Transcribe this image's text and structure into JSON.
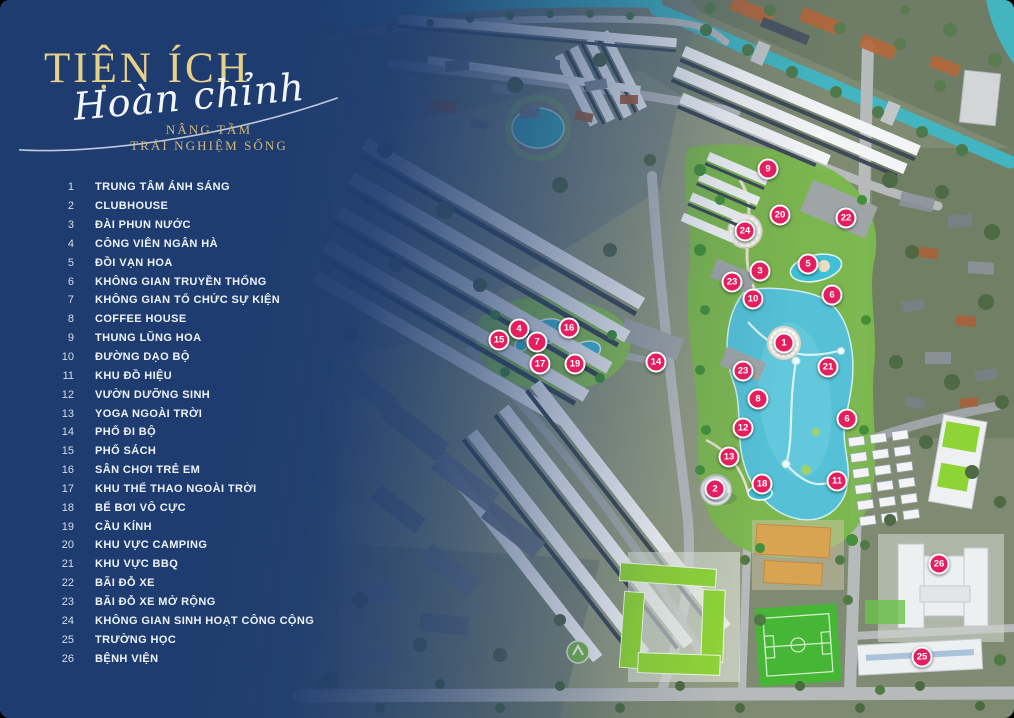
{
  "colors": {
    "navy": "#1e3c6f",
    "gold-title": "#e7d088",
    "gold-tagline": "#d2b878",
    "panel-text": "#edf3fb",
    "marker-bg": "#e51e5f",
    "marker-border": "#ffffff"
  },
  "panel": {
    "title": "TIỆN ÍCH",
    "subtitle_script": "Hoàn chỉnh",
    "tagline_line1": "NÂNG TẦM",
    "tagline_line2": "TRẢI NGHIỆM SỐNG",
    "items": [
      {
        "num": "1",
        "label": "TRUNG TÂM ÁNH SÁNG"
      },
      {
        "num": "2",
        "label": "CLUBHOUSE"
      },
      {
        "num": "3",
        "label": "ĐÀI PHUN NƯỚC"
      },
      {
        "num": "4",
        "label": "CÔNG VIÊN NGÂN HÀ"
      },
      {
        "num": "5",
        "label": "ĐỒI VẠN HOA"
      },
      {
        "num": "6",
        "label": "KHÔNG GIAN TRUYỀN THỐNG"
      },
      {
        "num": "7",
        "label": "KHÔNG GIAN TỔ CHỨC SỰ KIỆN"
      },
      {
        "num": "8",
        "label": "COFFEE HOUSE"
      },
      {
        "num": "9",
        "label": "THUNG LŨNG HOA"
      },
      {
        "num": "10",
        "label": "ĐƯỜNG DẠO BỘ"
      },
      {
        "num": "11",
        "label": "KHU ĐỒ HIỆU"
      },
      {
        "num": "12",
        "label": "VƯỜN DƯỠNG SINH"
      },
      {
        "num": "13",
        "label": "YOGA NGOÀI TRỜI"
      },
      {
        "num": "14",
        "label": "PHỐ ĐI BỘ"
      },
      {
        "num": "15",
        "label": "PHỐ SÁCH"
      },
      {
        "num": "16",
        "label": "SÂN CHƠI TRẺ EM"
      },
      {
        "num": "17",
        "label": "KHU THỂ THAO NGOÀI TRỜI"
      },
      {
        "num": "18",
        "label": "BỂ BƠI VÔ CỰC"
      },
      {
        "num": "19",
        "label": "CẦU KÍNH"
      },
      {
        "num": "20",
        "label": "KHU VỰC CAMPING"
      },
      {
        "num": "21",
        "label": "KHU VỰC BBQ"
      },
      {
        "num": "22",
        "label": "BÃI ĐỖ XE"
      },
      {
        "num": "23",
        "label": "BÃI ĐỖ XE MỞ RỘNG"
      },
      {
        "num": "24",
        "label": "KHÔNG GIAN SINH HOẠT CÔNG CỘNG"
      },
      {
        "num": "25",
        "label": "TRƯỜNG HỌC"
      },
      {
        "num": "26",
        "label": "BỆNH VIỆN"
      }
    ]
  },
  "map": {
    "markers": [
      {
        "n": "1",
        "x": 784,
        "y": 343
      },
      {
        "n": "2",
        "x": 715,
        "y": 489
      },
      {
        "n": "3",
        "x": 760,
        "y": 271
      },
      {
        "n": "4",
        "x": 519,
        "y": 329
      },
      {
        "n": "5",
        "x": 808,
        "y": 264
      },
      {
        "n": "6",
        "x": 832,
        "y": 295
      },
      {
        "n": "6",
        "x": 847,
        "y": 419
      },
      {
        "n": "7",
        "x": 537,
        "y": 342
      },
      {
        "n": "8",
        "x": 758,
        "y": 399
      },
      {
        "n": "9",
        "x": 768,
        "y": 169
      },
      {
        "n": "10",
        "x": 753,
        "y": 299
      },
      {
        "n": "11",
        "x": 837,
        "y": 481
      },
      {
        "n": "12",
        "x": 743,
        "y": 428
      },
      {
        "n": "13",
        "x": 729,
        "y": 457
      },
      {
        "n": "14",
        "x": 656,
        "y": 362
      },
      {
        "n": "15",
        "x": 499,
        "y": 340
      },
      {
        "n": "16",
        "x": 569,
        "y": 328
      },
      {
        "n": "17",
        "x": 540,
        "y": 364
      },
      {
        "n": "18",
        "x": 762,
        "y": 484
      },
      {
        "n": "19",
        "x": 575,
        "y": 364
      },
      {
        "n": "20",
        "x": 780,
        "y": 215
      },
      {
        "n": "21",
        "x": 828,
        "y": 367
      },
      {
        "n": "22",
        "x": 846,
        "y": 218
      },
      {
        "n": "23",
        "x": 732,
        "y": 282
      },
      {
        "n": "23",
        "x": 743,
        "y": 371
      },
      {
        "n": "24",
        "x": 745,
        "y": 231
      },
      {
        "n": "25",
        "x": 922,
        "y": 657
      },
      {
        "n": "26",
        "x": 939,
        "y": 564
      }
    ]
  }
}
